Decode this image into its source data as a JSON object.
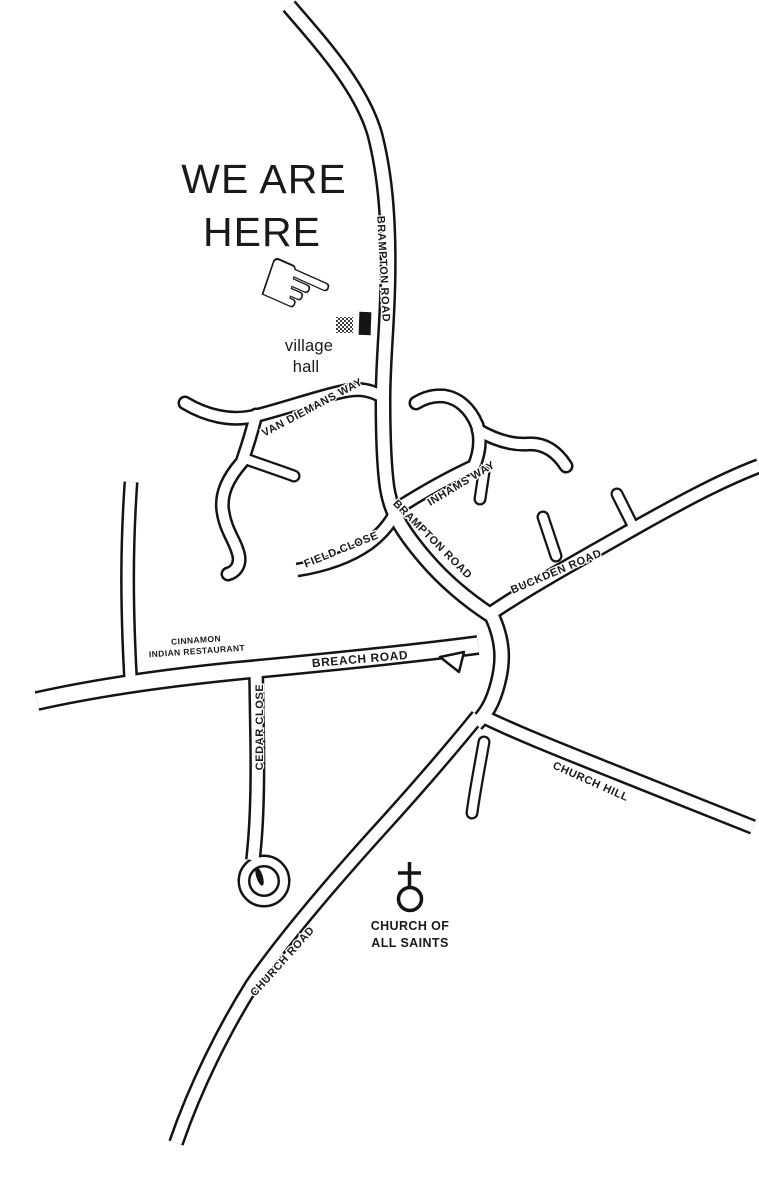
{
  "title": {
    "line1": "WE ARE",
    "line2": "HERE"
  },
  "marker": {
    "hand_icon_glyph": "☞",
    "venue_line1": "village",
    "venue_line2": "hall"
  },
  "roads": {
    "brampton_north": "BRAMPTON ROAD",
    "van_diemans": "VAN DIEMANS WAY",
    "inhams": "INHAMS WAY",
    "brampton_south": "BRAMPTON ROAD",
    "field_close": "FIELD CLOSE",
    "buckden": "BUCKDEN ROAD",
    "breach": "BREACH ROAD",
    "cedar_close": "CEDAR CLOSE",
    "church_hill": "CHURCH HILL",
    "church_road": "CHURCH ROAD"
  },
  "pois": {
    "restaurant_line1": "CINNAMON",
    "restaurant_line2": "INDIAN RESTAURANT",
    "church_line1": "CHURCH OF",
    "church_line2": "ALL SAINTS"
  },
  "colors": {
    "ink": "#141414",
    "road_fill": "#ffffff",
    "background": "#ffffff"
  }
}
